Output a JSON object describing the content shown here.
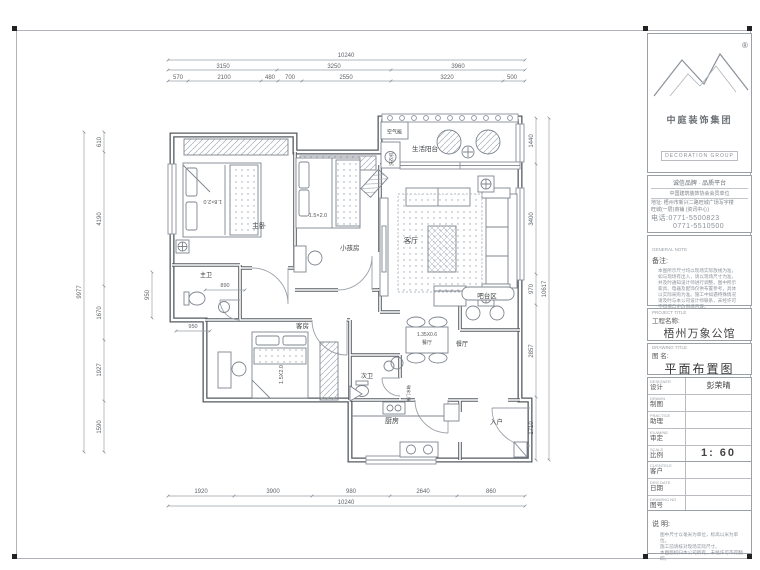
{
  "title_block": {
    "logo": {
      "registered": "®",
      "cn": "中庭装饰集团",
      "en": "DECORATION GROUP"
    },
    "slogan": "诚信品牌 · 品质平台",
    "member_line": "中国建筑装饰协会会员单位",
    "address1": "地址: 梧州市新兴二路旺城广场写字楼",
    "address2": "旺城(一层)商铺 (资讯中心)",
    "phone1": "电话:0771-5500823",
    "phone2": "0771-5510500",
    "general_note": {
      "en": "GENERAL NOTE",
      "cn": "备注:",
      "lines": [
        "本图所示尺寸均以现场实际放线为准，",
        "如与现场有出入，请以现场尺寸为准，",
        "并及时通知设计师进行调整。图中所示",
        "家具、电器及配饰仅供布置参考，具体",
        "以实际采购为准。施工中如遇特殊情况",
        "请及时与本公司设计师联系，未经许可",
        "不得擅自更改图纸内容。"
      ]
    },
    "project": {
      "en": "PROJECT TITLE",
      "cn": "工程名称:",
      "value": "梧州万象公馆"
    },
    "drawing": {
      "en": "DRAWING TITLE",
      "cn": "图  名:",
      "value": "平面布置图"
    },
    "fields": [
      {
        "en": "DESIGNER",
        "cn": "设计",
        "value": "彭荣晴"
      },
      {
        "en": "DRAWN",
        "cn": "制图",
        "value": ""
      },
      {
        "en": "PRACTICE",
        "cn": "助理",
        "value": ""
      },
      {
        "en": "EXAMINE",
        "cn": "审定",
        "value": ""
      },
      {
        "en": "SCALE",
        "cn": "比例",
        "value": "1: 60"
      },
      {
        "en": "CLIENTELE",
        "cn": "客户",
        "value": ""
      },
      {
        "en": "DRG DATE",
        "cn": "日期",
        "value": ""
      },
      {
        "en": "DRAWING NO",
        "cn": "图号",
        "value": ""
      }
    ],
    "remark": {
      "cn": "说  明:",
      "lines": [
        "图中尺寸以毫米为单位，标高以米为单位。",
        "施工前请核对现场实际尺寸。",
        "本图版权归本公司所有，未经许可不得翻印。"
      ]
    }
  },
  "plan": {
    "rooms": {
      "master_bedroom": "主卧",
      "kids_room": "小孩房",
      "living_room": "客厅",
      "balcony": "生活阳台",
      "guest_room": "客房",
      "master_bath": "主卫",
      "second_bath": "次卫",
      "kitchen": "厨房",
      "entry": "入户",
      "bar_area": "吧台区",
      "dining": "餐厅"
    },
    "equipment": {
      "air_heater": "空气能",
      "washer": "洗衣机",
      "fridge": "单门冰箱"
    },
    "furniture": {
      "master_bed": "1.8×2.0",
      "kids_bed": "1.5×2.0",
      "guest_bed": "1.5X2.0",
      "dining_size": "1.35X0.6",
      "dining_table_label": "餐厅"
    },
    "dims": {
      "top_total": "10240",
      "top_row2": [
        "3150",
        "3250",
        "3960"
      ],
      "top_row3": [
        "570",
        "2100",
        "480",
        "700",
        "2550",
        "3220",
        "500"
      ],
      "bottom": [
        "1920",
        "3900",
        "980",
        "2640",
        "860"
      ],
      "bottom_total": "10240",
      "left": [
        "610",
        "4190",
        "1670",
        "1927",
        "1590"
      ],
      "left_total": "9977",
      "left_inner": "950",
      "right": [
        "1440",
        "3400",
        "970",
        "2857",
        "1710"
      ],
      "right_total": "10617",
      "bath": "890",
      "hall": "950"
    }
  }
}
